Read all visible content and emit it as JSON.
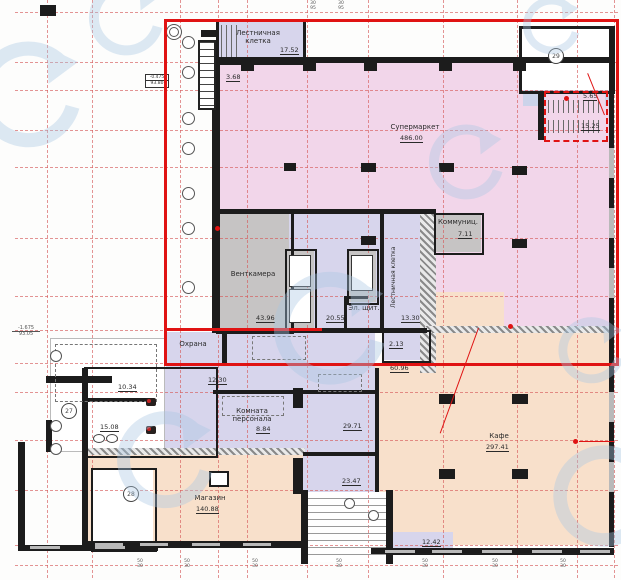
{
  "plan": {
    "rooms": {
      "stairTop": {
        "name1": "Лестничная",
        "name2": "клетка",
        "area": "17.52"
      },
      "dim368": "3.68",
      "supermarket": {
        "name": "Супермаркет",
        "area": "486.00"
      },
      "corridor565": "5.65",
      "stair1525": "15.25",
      "vent": {
        "name": "Венткамера",
        "area": "43.96"
      },
      "lobby": "20.55",
      "elPanel": "Эл. щит.",
      "stairMid": {
        "name": "Лестничная клетка",
        "area": "13.30"
      },
      "room213": "2.13",
      "commun": {
        "name": "Коммуниц.",
        "area": "7.11"
      },
      "security": "Охрана",
      "corridor6096": "60.96",
      "corridor1230": "12.30",
      "wc1": "10.34",
      "wc2": "15.08",
      "staff": {
        "name1": "Комната",
        "name2": "персонала",
        "area": "8.84"
      },
      "corridor2971": "29.71",
      "shop": {
        "name": "Магазин",
        "area": "140.88"
      },
      "vestibule": "23.47",
      "cafe": {
        "name": "Кафе",
        "area": "297.41"
      },
      "ramp": "12.42"
    },
    "markers": {
      "m27": "27",
      "m28": "28",
      "m29": "29"
    },
    "elevations": {
      "e1": {
        "top": "-0.475",
        "bottom": "93.80"
      },
      "e2": {
        "top": "-1.675",
        "bottom": "93.05"
      }
    },
    "dims": {
      "top": [
        "30",
        "95"
      ],
      "bottom": [
        "50",
        "30"
      ]
    }
  },
  "colors": {
    "pink": "#f2d6ea",
    "lavender": "#d7d5ec",
    "peach": "#f8e0cb",
    "gray_room": "#c6c4c4",
    "blue_strip": "#ccd3ea",
    "wall": "#1c1c1c",
    "red_outline": "#e01313",
    "grid_red": "#d55a5a",
    "watermark_blue": "#a9c7e3"
  }
}
